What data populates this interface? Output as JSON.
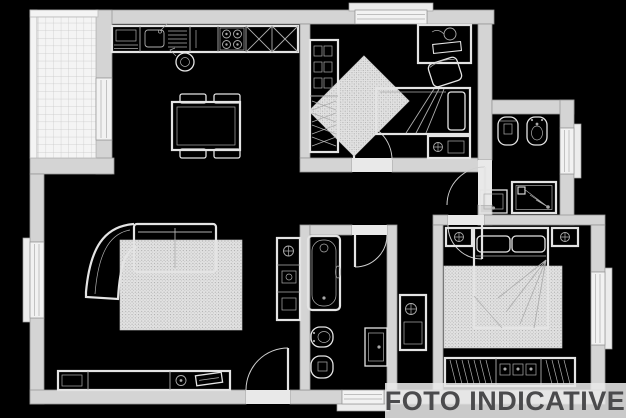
{
  "watermark": {
    "label": "FOTO INDICATIVE"
  },
  "colors": {
    "background": "#000000",
    "wall_fill": "#d4d4d4",
    "wall_stroke": "#979797",
    "line_light": "#e4e4e4",
    "line_gray": "#aeaeae",
    "rug_fill": "#e2e2e2",
    "watermark_band": "rgba(232,232,232,0.87)",
    "watermark_text": "#4b4b4d"
  },
  "plan": {
    "type": "apartment-floor-plan",
    "rooms": [
      "balcony-terrace",
      "living-room-with-open-kitchen",
      "small-bedroom-study",
      "ensuite-bathroom",
      "hallway",
      "main-bathroom",
      "master-bedroom"
    ],
    "furniture_symbols": [
      "kitchen-counter",
      "kitchen-sink",
      "cooktop-4-burners",
      "tall-kitchen-cabinets",
      "dining-table-with-chairs",
      "curved-sofa",
      "living-rug",
      "tv-sideboard",
      "appliance-cabinet",
      "wardrobe-shelves",
      "desk-with-chair",
      "single-bed",
      "bedside-cabinet",
      "toilet",
      "bidet",
      "washbasin",
      "shower-tray",
      "bathtub",
      "double-bed",
      "nightstand-left",
      "nightstand-right",
      "bedroom-rug",
      "wardrobe-hanging-clothes",
      "hall-cabinet"
    ],
    "openings": [
      "balcony-door",
      "entrance-door",
      "small-bedroom-door",
      "ensuite-bathroom-door",
      "main-bathroom-door",
      "master-bedroom-door",
      "window-top",
      "window-left",
      "window-ensuite",
      "window-master",
      "window-main-bathroom"
    ]
  }
}
